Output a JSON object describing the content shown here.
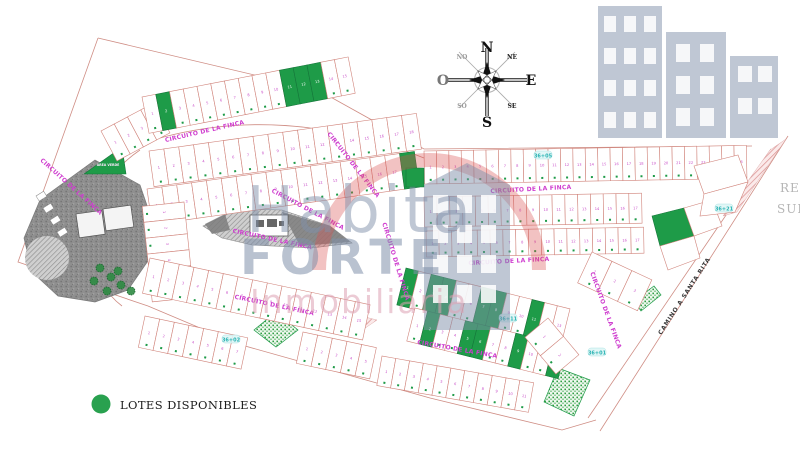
{
  "site": {
    "legend": {
      "label": "LOTES DISPONIBLES",
      "marker_color": "#29a14f"
    },
    "watermark": {
      "line1": "Habita",
      "line2": "FORTE",
      "line3": "Inmobiliaria"
    },
    "compass": {
      "n": "N",
      "s": "S",
      "e": "E",
      "o": "O",
      "ne": "NE",
      "no": "NO",
      "se": "SE",
      "so": "SO"
    },
    "streets": {
      "circuito": "CIRCUITO DE LA FINCA",
      "camino": "CAMINO A SANTA RITA"
    },
    "corner_text": {
      "line1": "RE",
      "line2": "SUP."
    },
    "green_area_label": "AREA VERDE",
    "stations": [
      {
        "label": "36+21",
        "x": 724,
        "y": 209
      },
      {
        "label": "36+05",
        "x": 543,
        "y": 156
      },
      {
        "label": "36+11",
        "x": 508,
        "y": 319
      },
      {
        "label": "36+01",
        "x": 597,
        "y": 353
      },
      {
        "label": "36+02",
        "x": 231,
        "y": 340
      }
    ],
    "street_labels": [
      {
        "street": "circuito",
        "x": 205,
        "y": 133,
        "rot": -13
      },
      {
        "street": "circuito",
        "x": 352,
        "y": 166,
        "rot": 52
      },
      {
        "street": "circuito",
        "x": 531,
        "y": 191,
        "rot": -3
      },
      {
        "street": "circuito",
        "x": 509,
        "y": 263,
        "rot": -3
      },
      {
        "street": "circuito",
        "x": 307,
        "y": 211,
        "rot": 28
      },
      {
        "street": "circuito",
        "x": 272,
        "y": 241,
        "rot": 12
      },
      {
        "street": "circuito",
        "x": 70,
        "y": 188,
        "rot": 42
      },
      {
        "street": "circuito",
        "x": 274,
        "y": 307,
        "rot": 12
      },
      {
        "street": "circuito",
        "x": 457,
        "y": 351,
        "rot": 10
      },
      {
        "street": "circuito",
        "x": 394,
        "y": 262,
        "rot": 73
      },
      {
        "street": "circuito",
        "x": 604,
        "y": 311,
        "rot": 70
      },
      {
        "street": "camino",
        "x": 686,
        "y": 297,
        "rot": -57
      }
    ],
    "colors": {
      "lot_stroke": "#d0837a",
      "lot_number": "#c94fc9",
      "available": "#1e9b48",
      "street_label": "#cf3ecf",
      "station": "#2ab3b3",
      "boundary": "#cf8d84",
      "gray_area": "#8d8d8d",
      "watermark_blue": "#8090aa",
      "watermark_red": "#d94f4f",
      "watermark_pink": "#dda0b2"
    },
    "lot_rows": [
      {
        "x": 101,
        "y": 131,
        "rot": -28,
        "count": 4,
        "w": 15,
        "h": 34,
        "available": []
      },
      {
        "x": 142,
        "y": 97,
        "rot": -11,
        "count": 15,
        "w": 14,
        "h": 37,
        "available": [
          1,
          10,
          11,
          12
        ]
      },
      {
        "x": 149,
        "y": 151,
        "rot": -8,
        "count": 18,
        "w": 15,
        "h": 36,
        "available": []
      },
      {
        "x": 147,
        "y": 189,
        "rot": -8,
        "count": 18,
        "w": 15,
        "h": 36,
        "available": [
          17
        ]
      },
      {
        "x": 184,
        "y": 202,
        "rot": 84,
        "count": 6,
        "w": 16,
        "h": 42,
        "available": []
      },
      {
        "x": 150,
        "y": 258,
        "rot": 12,
        "count": 15,
        "w": 15,
        "h": 36,
        "available": []
      },
      {
        "x": 145,
        "y": 316,
        "rot": 12,
        "count": 7,
        "w": 15,
        "h": 32,
        "available": []
      },
      {
        "x": 303,
        "y": 332,
        "rot": 12,
        "count": 5,
        "w": 15,
        "h": 32,
        "available": []
      },
      {
        "x": 382,
        "y": 356,
        "rot": 10,
        "count": 11,
        "w": 14,
        "h": 30,
        "available": []
      },
      {
        "x": 424,
        "y": 151,
        "rot": -1,
        "count": 26,
        "w": 12.4,
        "h": 33,
        "available": []
      },
      {
        "x": 424,
        "y": 197,
        "rot": -1,
        "count": 17,
        "w": 12.8,
        "h": 30,
        "available": []
      },
      {
        "x": 426,
        "y": 231,
        "rot": -1,
        "count": 17,
        "w": 12.8,
        "h": 26,
        "available": []
      },
      {
        "x": 406,
        "y": 268,
        "rot": 14,
        "count": 13,
        "w": 13,
        "h": 38,
        "available": [
          0,
          2,
          3,
          6,
          7,
          10
        ]
      },
      {
        "x": 415,
        "y": 308,
        "rot": 14,
        "count": 12,
        "w": 13,
        "h": 34,
        "available": [
          1,
          4,
          5,
          8,
          11
        ]
      },
      {
        "x": 592,
        "y": 252,
        "rot": 25,
        "count": 3,
        "w": 22,
        "h": 34,
        "available": []
      },
      {
        "x": 548,
        "y": 318,
        "rot": 50,
        "count": 2,
        "w": 24,
        "h": 30,
        "available": []
      }
    ],
    "corner_lots": [
      {
        "points": "652,216 684,208 694,236 660,246",
        "available": true
      },
      {
        "points": "660,246 694,236 700,258 668,270",
        "available": false
      },
      {
        "points": "684,208 712,200 722,226 694,236",
        "available": false
      },
      {
        "points": "694,166 738,155 748,182 704,194",
        "available": false
      },
      {
        "points": "704,194 748,182 735,212 700,216",
        "available": false
      },
      {
        "points": "406,168 424,168 424,187 406,187",
        "available": true
      }
    ],
    "parks": [
      {
        "points": "276,312 298,330 276,347 254,330"
      },
      {
        "points": "558,368 590,380 574,416 544,402"
      },
      {
        "points": "634,301 654,286 661,295 641,311"
      }
    ],
    "green_triangle": {
      "points": "84,174 122,147 126,174"
    },
    "boundary_paths": [
      "M 98,38 L 318,90 L 424,149 L 752,146",
      "M 98,38 L 18,262 L 148,306",
      "M 148,306 L 238,344 L 430,398 L 562,430 L 596,420",
      "M 788,136 L 600,431",
      "M 771,149 L 588,418",
      "M 134,146 Q 272,98 424,158",
      "M 140,150 Q 96,180 92,230 Q 90,282 122,306"
    ],
    "hatch_band": "770,150 786,139 737,212 723,216",
    "pink_triangle": "345,312 377,320 352,337",
    "median": {
      "outline": "203,226 238,209 282,210 330,226 352,243 312,248 252,245 222,238",
      "dark": [
        "282,212 330,226 350,242 300,246",
        "205,224 225,214 230,230 212,234"
      ],
      "building": {
        "x": 250,
        "y": 215,
        "w": 38,
        "h": 21
      }
    },
    "amenity": {
      "outline": "M 95,160 L 140,185 L 152,220 L 150,258 L 128,290 L 95,302 L 58,296 L 32,272 L 24,238 L 40,200 Z",
      "hatch_circle": {
        "cx": 47,
        "cy": 258,
        "r": 22
      },
      "buildings": [
        {
          "x": 76,
          "y": 214,
          "w": 26,
          "h": 24,
          "rot": -8
        },
        {
          "x": 103,
          "y": 209,
          "w": 28,
          "h": 22,
          "rot": -8
        }
      ],
      "trees": [
        [
          100,
          268
        ],
        [
          111,
          277
        ],
        [
          121,
          285
        ],
        [
          131,
          291
        ],
        [
          107,
          291
        ],
        [
          94,
          281
        ],
        [
          118,
          271
        ]
      ],
      "parking": [
        [
          36,
          196
        ],
        [
          43,
          208
        ],
        [
          50,
          220
        ],
        [
          57,
          232
        ]
      ]
    }
  }
}
